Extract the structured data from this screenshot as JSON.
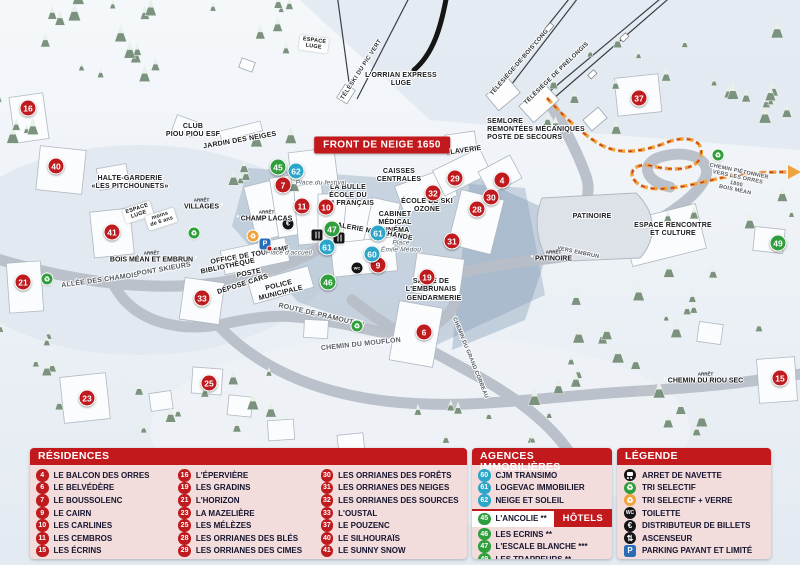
{
  "colors": {
    "residence": "#bf1a1e",
    "hotel": "#2f9e3c",
    "agency": "#2ba6c9",
    "accent": "#c2191d",
    "panel_bg": "#f3dcdc"
  },
  "map": {
    "banner": "FRONT DE NEIGE 1650",
    "labels": [
      {
        "t": "TÉLÉSKI DU PIC VERT",
        "x": 362,
        "y": 70,
        "r": -57,
        "c": "lift"
      },
      {
        "t": "TÉLÉSIÈGE DE BOIS LONG",
        "x": 520,
        "y": 63,
        "r": -49,
        "c": "lift"
      },
      {
        "t": "TÉLÉSIÈGE DE PRÉLONGIS",
        "x": 557,
        "y": 74,
        "r": -44,
        "c": "lift"
      },
      {
        "t": "L'ORRIAN EXPRESS\nLUGE",
        "x": 401,
        "y": 80,
        "r": 0,
        "c": ""
      },
      {
        "t": "SEMLORE\nREMONTÉES MÉCANIQUES\nPOSTE DE SECOURS",
        "x": 536,
        "y": 130,
        "r": 0,
        "c": "left"
      },
      {
        "t": "CLUB\nPIOU PIOU ESF",
        "x": 193,
        "y": 131,
        "r": 0,
        "c": ""
      },
      {
        "t": "JARDIN DES NEIGES",
        "x": 240,
        "y": 141,
        "r": -10,
        "c": ""
      },
      {
        "t": "HALTE-GARDERIE\n«LES PITCHOUNETS»",
        "x": 130,
        "y": 183,
        "r": 0,
        "c": ""
      },
      {
        "t": "ESPACE\nLUGE",
        "x": 138,
        "y": 212,
        "r": -18,
        "c": "ribbon"
      },
      {
        "t": "moins\nde 6 ans",
        "x": 161,
        "y": 219,
        "r": -18,
        "c": "ribbon"
      },
      {
        "t": "ESPACE\nLUGE",
        "x": 314,
        "y": 44,
        "r": 8,
        "c": "ribbon"
      },
      {
        "t": "LA BULLE\nÉCOLE DU\nSKI FRANÇAIS",
        "x": 348,
        "y": 196,
        "r": 0,
        "c": ""
      },
      {
        "t": "CAISSES\nCENTRALES",
        "x": 399,
        "y": 176,
        "r": 0,
        "c": ""
      },
      {
        "t": "LAVERIE",
        "x": 466,
        "y": 151,
        "r": -8,
        "c": ""
      },
      {
        "t": "ÉCOLE DE SKI\nOZONE",
        "x": 427,
        "y": 206,
        "r": 0,
        "c": ""
      },
      {
        "t": "CABINET\nMÉDICAL",
        "x": 395,
        "y": 219,
        "r": 0,
        "c": ""
      },
      {
        "t": "CINÉMA",
        "x": 395,
        "y": 231,
        "r": 0,
        "c": ""
      },
      {
        "t": "GALERIE MARCHANDE",
        "x": 372,
        "y": 232,
        "r": 10,
        "c": ""
      },
      {
        "t": "SALLE DE\nL'EMBRUNAIS",
        "x": 431,
        "y": 286,
        "r": 0,
        "c": ""
      },
      {
        "t": "GENDARMERIE",
        "x": 434,
        "y": 299,
        "r": 0,
        "c": ""
      },
      {
        "t": "OFFICE DE TOURISME",
        "x": 250,
        "y": 256,
        "r": -10,
        "c": ""
      },
      {
        "t": "BIBLIOTHÈQUE",
        "x": 228,
        "y": 267,
        "r": -12,
        "c": ""
      },
      {
        "t": "POSTE",
        "x": 249,
        "y": 274,
        "r": -12,
        "c": ""
      },
      {
        "t": "DÉPOSE CARS",
        "x": 243,
        "y": 285,
        "r": -18,
        "c": ""
      },
      {
        "t": "POLICE\nMUNICIPALE",
        "x": 280,
        "y": 290,
        "r": -14,
        "c": ""
      },
      {
        "t": "PATINOIRE",
        "x": 592,
        "y": 217,
        "r": 0,
        "c": ""
      },
      {
        "t": "ESPACE RENCONTRE\nET CULTURE",
        "x": 673,
        "y": 230,
        "r": 0,
        "c": ""
      },
      {
        "t": "Place du festival",
        "x": 321,
        "y": 183,
        "r": 0,
        "c": "it"
      },
      {
        "t": "Place d'accueil",
        "x": 289,
        "y": 253,
        "r": 0,
        "c": "it"
      },
      {
        "t": "Place\nÉmile Médou",
        "x": 401,
        "y": 247,
        "r": 0,
        "c": "it"
      },
      {
        "t": "ALLÉE DES CHAMOIS",
        "x": 100,
        "y": 281,
        "r": -8,
        "c": "road"
      },
      {
        "t": "PONT SKIEURS",
        "x": 164,
        "y": 270,
        "r": -10,
        "c": "road"
      },
      {
        "t": "ROUTE DE PRAMOUTON",
        "x": 321,
        "y": 316,
        "r": 13,
        "c": "road"
      },
      {
        "t": "CHEMIN DU MOUFLON",
        "x": 361,
        "y": 345,
        "r": -6,
        "c": "road"
      },
      {
        "t": "CHEMIN DU GRAND CORBEAU",
        "x": 470,
        "y": 358,
        "r": 68,
        "c": "road sm"
      },
      {
        "t": "CHEMIN PIÉTONNIER\nVERS LES ORRES 1800\nBOIS MÉAN",
        "x": 737,
        "y": 181,
        "r": 12,
        "c": "road sm"
      },
      {
        "t": "VERS EMBRUN",
        "x": 578,
        "y": 253,
        "r": 12,
        "c": "road sm"
      }
    ],
    "markers": [
      {
        "n": "16",
        "x": 28,
        "y": 108,
        "k": "res"
      },
      {
        "n": "40",
        "x": 56,
        "y": 166,
        "k": "res"
      },
      {
        "n": "41",
        "x": 112,
        "y": 232,
        "k": "res"
      },
      {
        "n": "21",
        "x": 23,
        "y": 282,
        "k": "res"
      },
      {
        "n": "33",
        "x": 202,
        "y": 298,
        "k": "res"
      },
      {
        "n": "23",
        "x": 87,
        "y": 398,
        "k": "res"
      },
      {
        "n": "25",
        "x": 209,
        "y": 383,
        "k": "res"
      },
      {
        "n": "7",
        "x": 283,
        "y": 185,
        "k": "res"
      },
      {
        "n": "11",
        "x": 302,
        "y": 206,
        "k": "res"
      },
      {
        "n": "10",
        "x": 326,
        "y": 207,
        "k": "res"
      },
      {
        "n": "9",
        "x": 378,
        "y": 265,
        "k": "res"
      },
      {
        "n": "19",
        "x": 427,
        "y": 277,
        "k": "res"
      },
      {
        "n": "6",
        "x": 424,
        "y": 332,
        "k": "res"
      },
      {
        "n": "31",
        "x": 452,
        "y": 241,
        "k": "res"
      },
      {
        "n": "28",
        "x": 477,
        "y": 209,
        "k": "res"
      },
      {
        "n": "30",
        "x": 491,
        "y": 197,
        "k": "res"
      },
      {
        "n": "32",
        "x": 433,
        "y": 193,
        "k": "res"
      },
      {
        "n": "29",
        "x": 455,
        "y": 178,
        "k": "res"
      },
      {
        "n": "4",
        "x": 502,
        "y": 180,
        "k": "res"
      },
      {
        "n": "37",
        "x": 639,
        "y": 98,
        "k": "res"
      },
      {
        "n": "15",
        "x": 780,
        "y": 378,
        "k": "res"
      },
      {
        "n": "45",
        "x": 278,
        "y": 167,
        "k": "hot"
      },
      {
        "n": "47",
        "x": 332,
        "y": 229,
        "k": "hot"
      },
      {
        "n": "46",
        "x": 328,
        "y": 282,
        "k": "hot"
      },
      {
        "n": "49",
        "x": 778,
        "y": 243,
        "k": "hot"
      },
      {
        "n": "62",
        "x": 296,
        "y": 171,
        "k": "agc"
      },
      {
        "n": "61",
        "x": 327,
        "y": 247,
        "k": "agc"
      },
      {
        "n": "61",
        "x": 378,
        "y": 233,
        "k": "agc"
      },
      {
        "n": "60",
        "x": 372,
        "y": 254,
        "k": "agc"
      }
    ],
    "icons": [
      {
        "t": "recycle-green",
        "x": 47,
        "y": 279
      },
      {
        "t": "recycle-green",
        "x": 194,
        "y": 233
      },
      {
        "t": "recycle-green",
        "x": 357,
        "y": 326
      },
      {
        "t": "recycle-green",
        "x": 718,
        "y": 155
      },
      {
        "t": "recycle-yellow",
        "x": 253,
        "y": 236
      },
      {
        "t": "parking",
        "x": 265,
        "y": 238
      },
      {
        "t": "euro",
        "x": 288,
        "y": 224
      },
      {
        "t": "wc",
        "x": 357,
        "y": 268
      },
      {
        "t": "resto",
        "x": 306,
        "y": 233
      },
      {
        "t": "resto",
        "x": 317,
        "y": 236
      }
    ],
    "stops": [
      {
        "arret": "ARRÊT",
        "name": "VILLAGES",
        "x": 203,
        "y": 204,
        "bus": "right"
      },
      {
        "arret": "ARRÊT",
        "name": "CHAMP LACAS",
        "x": 265,
        "y": 216,
        "bus": "left"
      },
      {
        "arret": "ARRÊT",
        "name": "BOIS MÉAN ET EMBRUN",
        "x": 153,
        "y": 257,
        "bus": "right"
      },
      {
        "arret": "ARRÊT",
        "name": "PATINOIRE",
        "x": 552,
        "y": 256,
        "bus": "left"
      },
      {
        "arret": "ARRÊT",
        "name": "CHEMIN DU RIOU SEC",
        "x": 704,
        "y": 378,
        "bus": "left"
      }
    ]
  },
  "panels": {
    "residences": {
      "title": "RÉSIDENCES",
      "items": [
        {
          "n": "4",
          "label": "LE BALCON DES ORRES"
        },
        {
          "n": "6",
          "label": "LE BELVÉDÈRE"
        },
        {
          "n": "7",
          "label": "LE BOUSSOLENC"
        },
        {
          "n": "9",
          "label": "LE CAIRN"
        },
        {
          "n": "10",
          "label": "LES CARLINES"
        },
        {
          "n": "11",
          "label": "LES CEMBROS"
        },
        {
          "n": "15",
          "label": "LES ÉCRINS"
        },
        {
          "n": "16",
          "label": "L'ÉPERVIÈRE"
        },
        {
          "n": "19",
          "label": "LES GRADINS"
        },
        {
          "n": "21",
          "label": "L'HORIZON"
        },
        {
          "n": "23",
          "label": "LA MAZELIÈRE"
        },
        {
          "n": "25",
          "label": "LES MÉLÈZES"
        },
        {
          "n": "28",
          "label": "LES ORRIANES DES BLÉS"
        },
        {
          "n": "29",
          "label": "LES ORRIANES DES CIMES"
        },
        {
          "n": "30",
          "label": "LES ORRIANES DES FORÊTS"
        },
        {
          "n": "31",
          "label": "LES ORRIANES DES NEIGES"
        },
        {
          "n": "32",
          "label": "LES ORRIANES DES SOURCES"
        },
        {
          "n": "33",
          "label": "L'OUSTAL"
        },
        {
          "n": "37",
          "label": "LE POUZENC"
        },
        {
          "n": "40",
          "label": "LE SILHOURAÏS"
        },
        {
          "n": "41",
          "label": "LE SUNNY SNOW"
        }
      ]
    },
    "agences": {
      "title": "AGENCES IMMOBILIÈRES",
      "items": [
        {
          "n": "60",
          "label": "CJM TRANSIMO"
        },
        {
          "n": "61",
          "label": "LOGEVAC IMMOBILIER"
        },
        {
          "n": "62",
          "label": "NEIGE ET SOLEIL"
        }
      ]
    },
    "hotels": {
      "tag": "HÔTELS",
      "items": [
        {
          "n": "45",
          "label": "L'ANCOLIE **"
        },
        {
          "n": "46",
          "label": "LES ECRINS **"
        },
        {
          "n": "47",
          "label": "L'ESCALE BLANCHE ***"
        },
        {
          "n": "49",
          "label": "LES TRAPPEURS **"
        }
      ]
    },
    "legende": {
      "title": "LÉGENDE",
      "items": [
        {
          "icon": "bus",
          "label": "ARRET DE NAVETTE"
        },
        {
          "icon": "recycle-green",
          "label": "TRI SELECTIF"
        },
        {
          "icon": "recycle-yellow",
          "label": "TRI SELECTIF + VERRE"
        },
        {
          "icon": "wc",
          "label": "TOILETTE"
        },
        {
          "icon": "euro",
          "label": "DISTRIBUTEUR DE BILLETS"
        },
        {
          "icon": "elevator",
          "label": "ASCENSEUR"
        },
        {
          "icon": "parking",
          "label": "PARKING PAYANT ET LIMITÉ"
        }
      ]
    }
  }
}
